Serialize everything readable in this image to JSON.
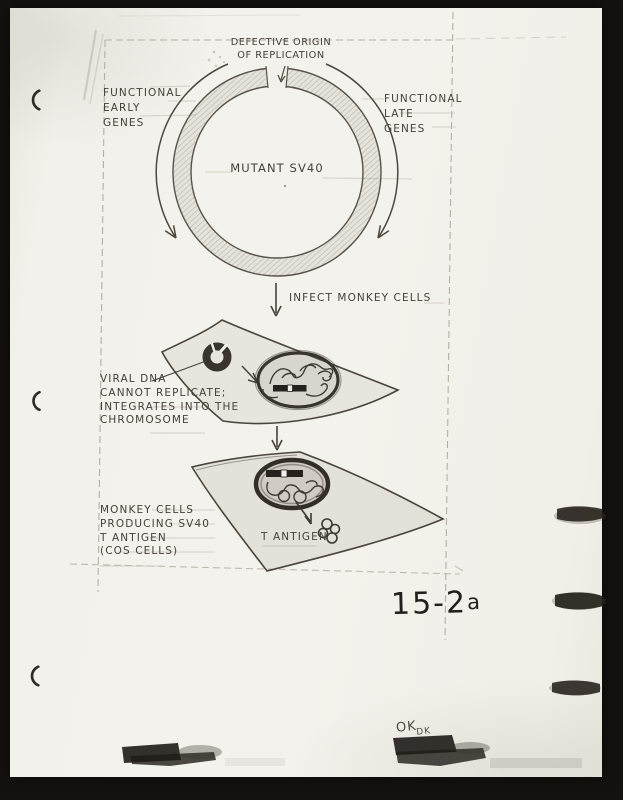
{
  "scan": {
    "figure_number_main": "15-2",
    "figure_number_suffix": "a",
    "approval_main": "OK",
    "approval_initials": "DK"
  },
  "diagram": {
    "origin_label_line1": "DEFECTIVE ORIGIN",
    "origin_label_line2": "OF REPLICATION",
    "early_genes": [
      "FUNCTIONAL",
      "EARLY",
      "GENES"
    ],
    "late_genes": [
      "FUNCTIONAL",
      "LATE",
      "GENES"
    ],
    "plasmid_name": "MUTANT SV40",
    "step1_label": "INFECT MONKEY CELLS",
    "cell1_caption": [
      "VIRAL DNA",
      "CANNOT REPLICATE;",
      "INTEGRATES INTO THE",
      "CHROMOSOME"
    ],
    "cell2_caption": [
      "MONKEY CELLS",
      "PRODUCING SV40",
      "T ANTIGEN",
      "(COS CELLS)"
    ],
    "t_antigen_label": "T ANTIGEN"
  },
  "colors": {
    "ink": "#45403a",
    "pencil": "#b3afa5",
    "marker": "#1f1b17",
    "paper": "#f2f0ea",
    "background": "#15110e"
  }
}
